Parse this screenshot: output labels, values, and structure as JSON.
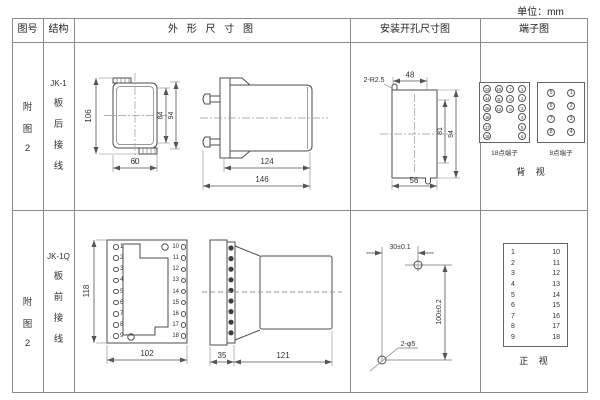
{
  "unit_note": "单位：mm",
  "headers": {
    "fig_no": "图号",
    "structure": "结构",
    "outline": "外 形 尺 寸 图",
    "install": "安装开孔尺寸图",
    "terminal": "端子图"
  },
  "row1": {
    "fig_chars": [
      "附",
      "图",
      "2"
    ],
    "model": "JK-1",
    "wiring_chars": [
      "板",
      "后",
      "接",
      "线"
    ],
    "outline_dims": {
      "height_overall": "106",
      "height_case": "84",
      "height_mid": "94",
      "width": "60",
      "length_body": "124",
      "length_overall": "146"
    },
    "install_dims": {
      "notch": "2-R2.5",
      "width_top": "48",
      "height_inner": "81",
      "height_outer": "94",
      "width_bottom": "56"
    },
    "terminal": {
      "grid18": [
        [
          "13",
          "14",
          "15",
          "16",
          "17",
          "18"
        ],
        [
          "10",
          "11",
          "12"
        ],
        [
          "7",
          "8",
          "9"
        ],
        [
          "1",
          "2",
          "3",
          "4",
          "5",
          "6"
        ]
      ],
      "grid8": [
        [
          "5",
          "6",
          "7",
          "8"
        ],
        [
          "1",
          "2",
          "3",
          "4"
        ]
      ],
      "label18": "18点端子",
      "label8": "8点端子",
      "view": "背 视"
    }
  },
  "row2": {
    "fig_chars": [
      "附",
      "图",
      "2"
    ],
    "model": "JK-1Q",
    "wiring_chars": [
      "板",
      "前",
      "接",
      "线"
    ],
    "outline_dims": {
      "height": "118",
      "width": "102",
      "flange_depth": "35",
      "body_length": "121"
    },
    "front_terminals_left": [
      "1",
      "2",
      "3",
      "4",
      "5",
      "6",
      "7",
      "8",
      "9"
    ],
    "front_terminals_right": [
      "10",
      "11",
      "12",
      "13",
      "14",
      "15",
      "16",
      "17",
      "18"
    ],
    "install_dims": {
      "width": "30±0.1",
      "height": "100±0.2",
      "holes": "2-φ5"
    },
    "terminal": {
      "left": [
        "1",
        "2",
        "3",
        "4",
        "5",
        "6",
        "7",
        "8",
        "9"
      ],
      "right": [
        "10",
        "11",
        "12",
        "13",
        "14",
        "15",
        "16",
        "17",
        "18"
      ],
      "view": "正 视"
    }
  }
}
